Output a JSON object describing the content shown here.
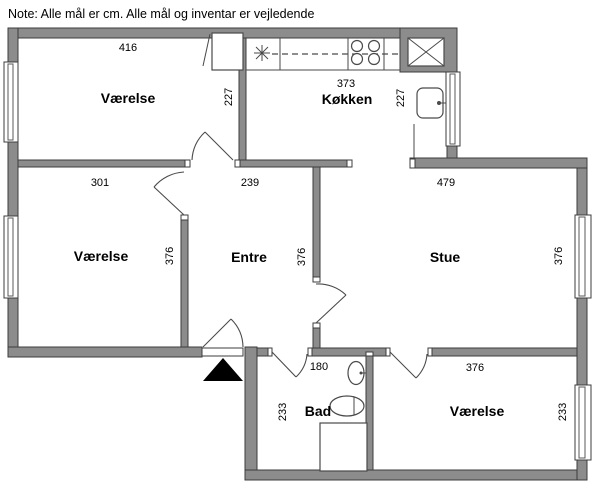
{
  "note": "Note: Alle mål er cm. Alle mål og inventar er vejledende",
  "rooms": {
    "nw": {
      "name": "Værelse",
      "width": "416",
      "height": "227"
    },
    "kitchen": {
      "name": "Køkken",
      "width": "373",
      "height": "227"
    },
    "w": {
      "name": "Værelse",
      "width": "301",
      "height": "376"
    },
    "entre": {
      "name": "Entre",
      "width": "239",
      "height": "376"
    },
    "stue": {
      "name": "Stue",
      "width": "479",
      "height": "376"
    },
    "bad": {
      "name": "Bad",
      "width": "180",
      "height": "233"
    },
    "se": {
      "name": "Værelse",
      "width": "376",
      "height": "233"
    }
  },
  "colors": {
    "wall_fill": "#8c8c8c",
    "wall_stroke": "#3c3c3c",
    "fixture_line": "#4a4a4a",
    "background": "#ffffff",
    "text": "#000000",
    "entrance_arrow": "#000000"
  },
  "icons": [
    {
      "name": "sink-symbol-icon",
      "glyph": "✳"
    },
    {
      "name": "cooktop-icon",
      "glyph": "◯◯◯◯"
    },
    {
      "name": "vent-shaft-icon",
      "glyph": "☒"
    },
    {
      "name": "kitchen-sink-icon",
      "glyph": "▢"
    },
    {
      "name": "wardrobe-icon",
      "glyph": "▭"
    },
    {
      "name": "wash-basin-icon",
      "glyph": "⬭"
    },
    {
      "name": "toilet-icon",
      "glyph": "⬬"
    },
    {
      "name": "shower-icon",
      "glyph": "□"
    },
    {
      "name": "window-icon",
      "glyph": "▯"
    },
    {
      "name": "door-swing-icon",
      "glyph": "⌒"
    },
    {
      "name": "entrance-arrow-icon",
      "glyph": "▲"
    }
  ]
}
